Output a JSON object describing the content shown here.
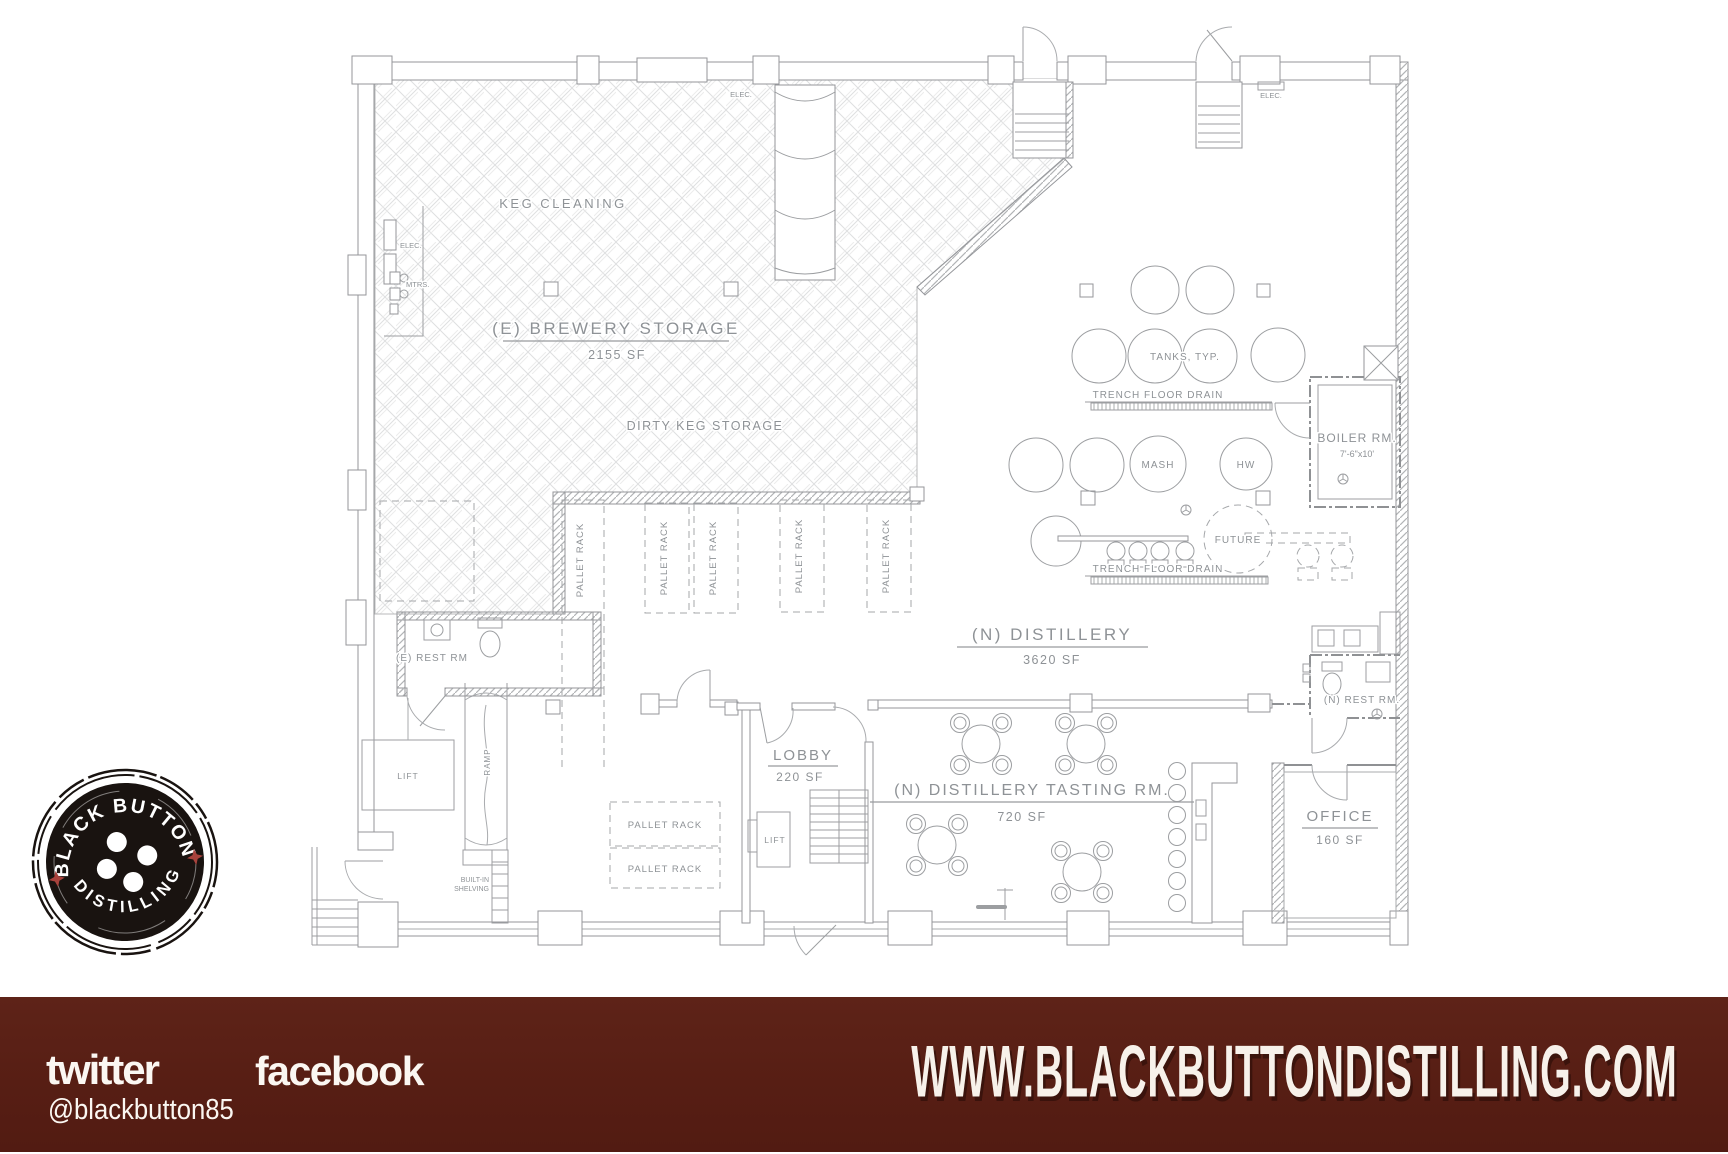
{
  "floorplan": {
    "rooms": {
      "brewery_storage": {
        "name": "(E) BREWERY STORAGE",
        "area": "2155 SF"
      },
      "distillery": {
        "name": "(N) DISTILLERY",
        "area": "3620 SF"
      },
      "tasting": {
        "name": "(N) DISTILLERY TASTING RM.",
        "area": "720 SF"
      },
      "lobby": {
        "name": "LOBBY",
        "area": "220 SF"
      },
      "office": {
        "name": "OFFICE",
        "area": "160 SF"
      },
      "boiler": {
        "name": "BOILER RM.",
        "dims": "7'-6\"x10'"
      },
      "rest_rm_existing": {
        "name": "(E) REST RM"
      },
      "rest_rm_new": {
        "name": "(N) REST RM."
      }
    },
    "labels": {
      "keg_cleaning": "KEG CLEANING",
      "dirty_keg_storage": "DIRTY KEG STORAGE",
      "pallet_rack": "PALLET RACK",
      "tanks_typ": "TANKS, TYP.",
      "trench_floor_drain": "TRENCH FLOOR DRAIN",
      "mash": "MASH",
      "hw": "HW",
      "future": "FUTURE",
      "lift": "LIFT",
      "ramp": "RAMP",
      "elec": "ELEC.",
      "mtrs": "MTRS.",
      "built_in_shelving_1": "BUILT-IN",
      "built_in_shelving_2": "SHELVING"
    }
  },
  "logo": {
    "arc_top": "BLACK BUTTON",
    "arc_bottom": "DISTILLING",
    "button_color": "#191310",
    "star_color": "#a8423c"
  },
  "footer": {
    "bar_color": "#571e14",
    "twitter": {
      "wordmark": "twitter",
      "handle": "@blackbutton85"
    },
    "facebook": {
      "wordmark": "facebook"
    },
    "website": "WWW.BLACKBUTTONDISTILLING.COM"
  }
}
